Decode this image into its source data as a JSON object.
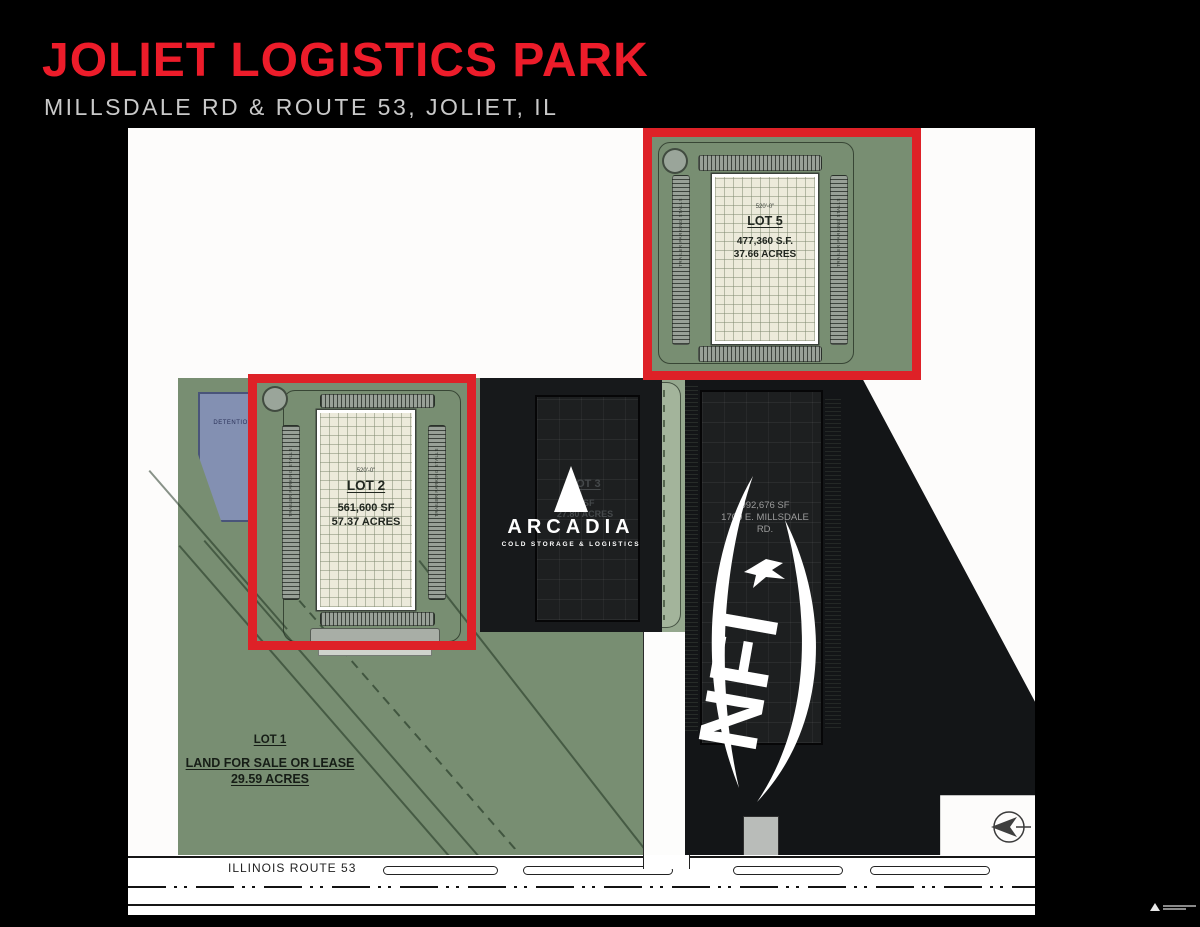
{
  "header": {
    "title": "JOLIET LOGISTICS PARK",
    "subtitle": "MILLSDALE RD & ROUTE 53, JOLIET, IL"
  },
  "plan": {
    "lot1": {
      "name": "LOT 1",
      "line1": "LAND FOR SALE OR LEASE",
      "line2": "29.59 ACRES"
    },
    "lot2": {
      "name": "LOT 2",
      "dimension": "520'-0\"",
      "sf": "561,600 SF",
      "acres": "57.37 ACRES"
    },
    "lot3": {
      "name": "LOT 3",
      "sf": "0 SF",
      "acres": "27.80 ACRES"
    },
    "lot5": {
      "name": "LOT 5",
      "dimension": "520'-0\"",
      "sf": "477,360 S.F.",
      "acres": "37.66 ACRES"
    },
    "detention_label": "DETENTION",
    "stall_label": "TRAILER PARKING STALLS",
    "arcadia": {
      "wordmark": "ARCADIA",
      "tagline": "COLD STORAGE & LOGISTICS"
    },
    "nfi": {
      "logo": "NFI",
      "sf": "992,676 SF",
      "address_line1": "1700 E. MILLSDALE",
      "address_line2": "RD."
    },
    "roads": {
      "route53": "ILLINOIS ROUTE 53",
      "millsdale": "MILLSDALE ROAD"
    }
  },
  "colors": {
    "accent_red": "#de2127",
    "title_red": "#ed1c2a",
    "site_green": "#788e72",
    "overlay_dark": "#131517",
    "pond_blue": "#8390b2"
  }
}
